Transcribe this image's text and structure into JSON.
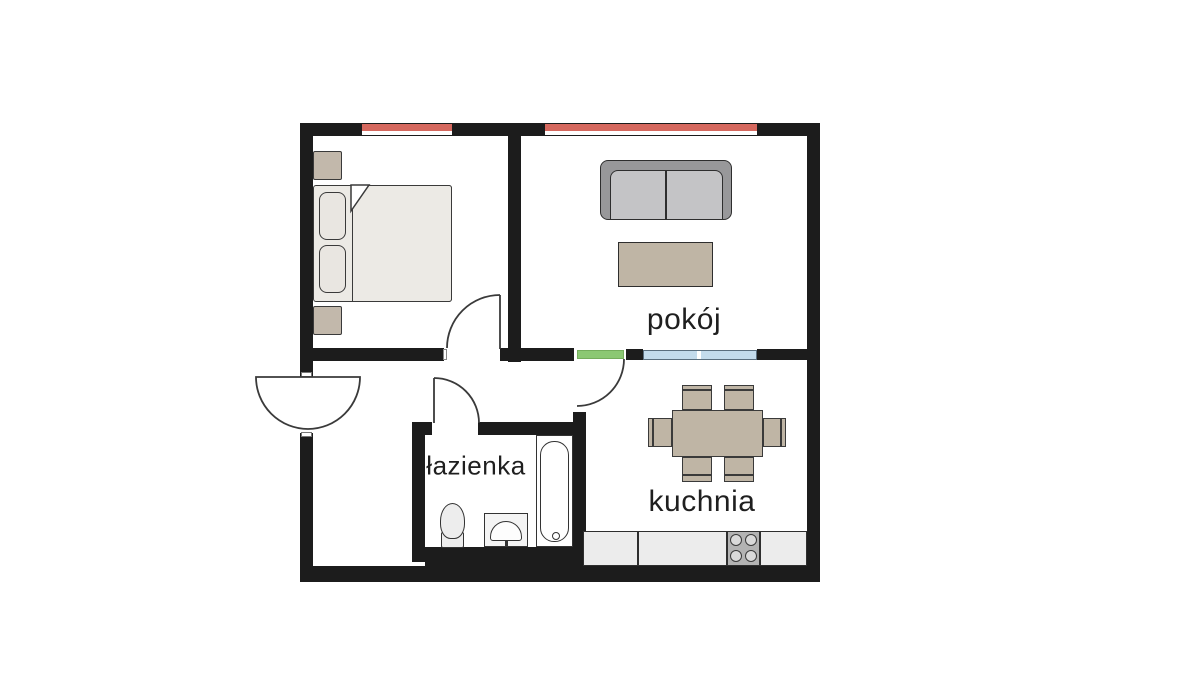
{
  "canvas": {
    "width": 1200,
    "height": 675,
    "background": "#ffffff"
  },
  "labels": {
    "living_room": "pokój",
    "bathroom": "łazienka",
    "kitchen": "kuchnia"
  },
  "colors": {
    "wall": "#1c1c1c",
    "outline": "#3a3a3a",
    "window_red": "#d5685e",
    "window_blue": "#c3dbec",
    "window_divider": "#ffffff",
    "door_green": "#8bc873",
    "bed": "#eceae5",
    "pillow": "#e9e6e1",
    "nightstand": "#c2b8ab",
    "sofa_outer": "#98989a",
    "sofa_inner": "#c4c4c6",
    "table_beige": "#bfb5a5",
    "counter": "#ececec",
    "stove": "#b3b3b3",
    "burner": "#d9d9d9",
    "fixture": "#ededed"
  },
  "rooms": [
    {
      "id": "bedroom",
      "label": "",
      "furniture": [
        "double-bed",
        "pillow",
        "pillow",
        "nightstand",
        "nightstand"
      ]
    },
    {
      "id": "living_room",
      "label": "pokój",
      "furniture": [
        "sofa",
        "coffee-table"
      ]
    },
    {
      "id": "bathroom",
      "label": "łazienka",
      "furniture": [
        "toilet",
        "sink",
        "bathtub"
      ]
    },
    {
      "id": "kitchen",
      "label": "kuchnia",
      "furniture": [
        "dining-table",
        "chair",
        "chair",
        "chair",
        "chair",
        "chair",
        "chair",
        "kitchen-counter",
        "stove-4-burners"
      ]
    }
  ],
  "openings": {
    "windows": [
      "bedroom-window-red",
      "living-room-window-red",
      "interior-window-blue"
    ],
    "doors": [
      "entrance-door-180",
      "bedroom-door",
      "bathroom-door",
      "kitchen-green-door"
    ]
  }
}
